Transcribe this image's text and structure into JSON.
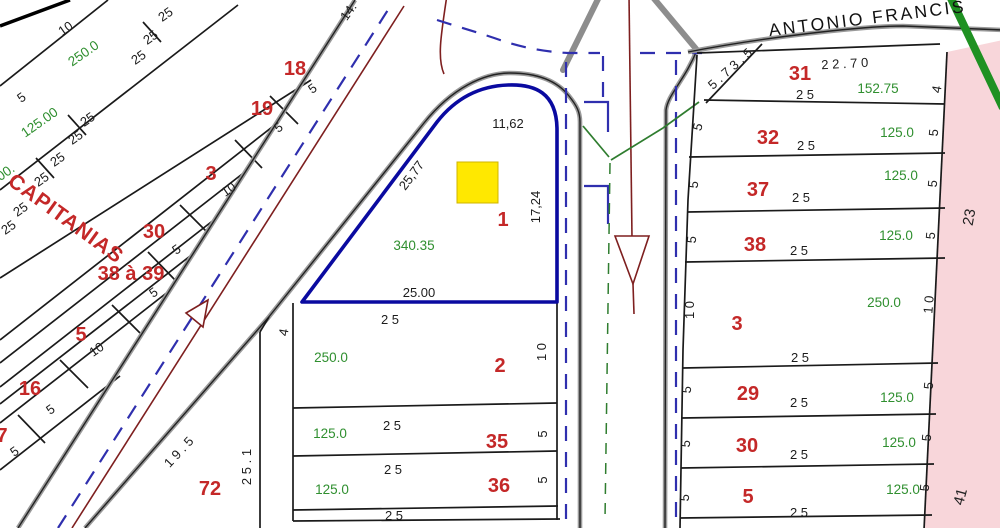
{
  "map": {
    "streets": {
      "diagonal_street": "CAPITANIAS",
      "top_street": "ANTONIO FRANCIS"
    },
    "highlight_lot": {
      "number": "1",
      "area": "340.35",
      "dim_top": "11,62",
      "dim_left": "25,77",
      "dim_right": "17,24",
      "dim_bottom": "25.00",
      "marker_color": "#ffe800",
      "outline_color": "#0a0aa0"
    },
    "colors": {
      "lot_number": "#c42828",
      "dimension": "#1c1c1c",
      "area": "#2f8f2f",
      "road_center_dash": "#2f2fae",
      "flow_line": "#7e1f1f",
      "utility_line": "#2f7d2f",
      "boundary_green": "#1f9122",
      "adjacent_fill": "#f8d6da"
    },
    "adjacent_plan_labels": [
      "23",
      "41"
    ],
    "labels": [
      {
        "t": "10",
        "x": 68,
        "y": 32,
        "r": -35,
        "k": "dim"
      },
      {
        "t": "250.0",
        "x": 86,
        "y": 57,
        "r": -35,
        "k": "area"
      },
      {
        "t": "25",
        "x": 168,
        "y": 18,
        "r": -35,
        "k": "dim"
      },
      {
        "t": "25",
        "x": 153,
        "y": 41,
        "r": -35,
        "k": "dim"
      },
      {
        "t": "25",
        "x": 141,
        "y": 61,
        "r": -35,
        "k": "dim"
      },
      {
        "t": "18",
        "x": 295,
        "y": 75,
        "r": 0,
        "k": "num"
      },
      {
        "t": "5",
        "x": 315,
        "y": 92,
        "r": -35,
        "k": "dim"
      },
      {
        "t": "19",
        "x": 262,
        "y": 115,
        "r": 0,
        "k": "num"
      },
      {
        "t": "5",
        "x": 281,
        "y": 131,
        "r": -35,
        "k": "dim"
      },
      {
        "t": "5",
        "x": 24,
        "y": 101,
        "r": -35,
        "k": "dim"
      },
      {
        "t": "125.00",
        "x": 42,
        "y": 126,
        "r": -35,
        "k": "area"
      },
      {
        "t": "25",
        "x": 90,
        "y": 123,
        "r": -35,
        "k": "dim"
      },
      {
        "t": "25",
        "x": 78,
        "y": 141,
        "r": -35,
        "k": "dim"
      },
      {
        "t": "3",
        "x": 211,
        "y": 180,
        "r": 0,
        "k": "num"
      },
      {
        "t": "10",
        "x": 231,
        "y": 193,
        "r": -35,
        "k": "dim"
      },
      {
        "t": "25",
        "x": 60,
        "y": 163,
        "r": -35,
        "k": "dim"
      },
      {
        "t": "25",
        "x": 44,
        "y": 183,
        "r": -35,
        "k": "dim"
      },
      {
        "t": "00.",
        "x": 8,
        "y": 176,
        "r": -35,
        "k": "area"
      },
      {
        "t": "30",
        "x": 154,
        "y": 238,
        "r": 0,
        "k": "num"
      },
      {
        "t": "5",
        "x": 179,
        "y": 253,
        "r": -35,
        "k": "dim"
      },
      {
        "t": "25",
        "x": 23,
        "y": 213,
        "r": -35,
        "k": "dim"
      },
      {
        "t": "25",
        "x": 11,
        "y": 231,
        "r": -35,
        "k": "dim"
      },
      {
        "t": "38 à 39",
        "x": 131,
        "y": 280,
        "r": 0,
        "k": "num"
      },
      {
        "t": "5",
        "x": 156,
        "y": 296,
        "r": -35,
        "k": "dim"
      },
      {
        "t": "5",
        "x": 81,
        "y": 341,
        "r": 0,
        "k": "num"
      },
      {
        "t": "10",
        "x": 99,
        "y": 353,
        "r": -35,
        "k": "dim"
      },
      {
        "t": "16",
        "x": 30,
        "y": 395,
        "r": 0,
        "k": "num"
      },
      {
        "t": "5",
        "x": 53,
        "y": 413,
        "r": -35,
        "k": "dim"
      },
      {
        "t": "7",
        "x": 2,
        "y": 442,
        "r": 0,
        "k": "num"
      },
      {
        "t": "5",
        "x": 17,
        "y": 455,
        "r": -35,
        "k": "dim"
      },
      {
        "t": "14.",
        "x": 352,
        "y": 14,
        "r": -55,
        "k": "dim"
      },
      {
        "t": "72",
        "x": 210,
        "y": 495,
        "r": 0,
        "k": "num"
      },
      {
        "t": "1 9 . 5",
        "x": 182,
        "y": 455,
        "r": -47,
        "k": "dim"
      },
      {
        "t": "2 5 . 1",
        "x": 251,
        "y": 467,
        "r": -90,
        "k": "dim"
      },
      {
        "t": "4",
        "x": 288,
        "y": 333,
        "r": -80,
        "k": "dim"
      },
      {
        "t": "2 5",
        "x": 390,
        "y": 324,
        "r": 0,
        "k": "dim"
      },
      {
        "t": "250.0",
        "x": 331,
        "y": 362,
        "r": 0,
        "k": "area"
      },
      {
        "t": "2",
        "x": 500,
        "y": 372,
        "r": 0,
        "k": "num"
      },
      {
        "t": "1 0",
        "x": 546,
        "y": 352,
        "r": -90,
        "k": "dim"
      },
      {
        "t": "2 5",
        "x": 392,
        "y": 430,
        "r": 0,
        "k": "dim"
      },
      {
        "t": "125.0",
        "x": 330,
        "y": 438,
        "r": 0,
        "k": "area"
      },
      {
        "t": "35",
        "x": 497,
        "y": 448,
        "r": 0,
        "k": "num"
      },
      {
        "t": "5",
        "x": 547,
        "y": 434,
        "r": -90,
        "k": "dim"
      },
      {
        "t": "2 5",
        "x": 393,
        "y": 474,
        "r": 0,
        "k": "dim"
      },
      {
        "t": "125.0",
        "x": 332,
        "y": 494,
        "r": 0,
        "k": "area"
      },
      {
        "t": "36",
        "x": 499,
        "y": 492,
        "r": 0,
        "k": "num"
      },
      {
        "t": "5",
        "x": 547,
        "y": 480,
        "r": -90,
        "k": "dim"
      },
      {
        "t": "2 5",
        "x": 394,
        "y": 520,
        "r": 0,
        "k": "dim"
      },
      {
        "t": "31",
        "x": 800,
        "y": 80,
        "r": 0,
        "k": "num"
      },
      {
        "t": "5 . 7 3 . 5",
        "x": 733,
        "y": 72,
        "r": -42,
        "k": "dim"
      },
      {
        "t": "2 2 . 7 0",
        "x": 845,
        "y": 68,
        "r": -3,
        "k": "dim"
      },
      {
        "t": "2 5",
        "x": 805,
        "y": 99,
        "r": 0,
        "k": "dim"
      },
      {
        "t": "152.75",
        "x": 878,
        "y": 93,
        "r": 0,
        "k": "area"
      },
      {
        "t": "4",
        "x": 941,
        "y": 90,
        "r": -80,
        "k": "dim"
      },
      {
        "t": "5",
        "x": 702,
        "y": 128,
        "r": -75,
        "k": "dim"
      },
      {
        "t": "32",
        "x": 768,
        "y": 144,
        "r": 0,
        "k": "num"
      },
      {
        "t": "2 5",
        "x": 806,
        "y": 150,
        "r": 0,
        "k": "dim"
      },
      {
        "t": "125.0",
        "x": 897,
        "y": 137,
        "r": 0,
        "k": "area"
      },
      {
        "t": "5",
        "x": 938,
        "y": 133,
        "r": -85,
        "k": "dim"
      },
      {
        "t": "5",
        "x": 698,
        "y": 185,
        "r": -85,
        "k": "dim"
      },
      {
        "t": "37",
        "x": 758,
        "y": 196,
        "r": 0,
        "k": "num"
      },
      {
        "t": "2 5",
        "x": 801,
        "y": 202,
        "r": 0,
        "k": "dim"
      },
      {
        "t": "125.0",
        "x": 901,
        "y": 180,
        "r": 0,
        "k": "area"
      },
      {
        "t": "5",
        "x": 937,
        "y": 184,
        "r": -85,
        "k": "dim"
      },
      {
        "t": "5",
        "x": 696,
        "y": 240,
        "r": -85,
        "k": "dim"
      },
      {
        "t": "38",
        "x": 755,
        "y": 251,
        "r": 0,
        "k": "num"
      },
      {
        "t": "2 5",
        "x": 799,
        "y": 255,
        "r": 0,
        "k": "dim"
      },
      {
        "t": "125.0",
        "x": 896,
        "y": 240,
        "r": 0,
        "k": "area"
      },
      {
        "t": "5",
        "x": 935,
        "y": 236,
        "r": -85,
        "k": "dim"
      },
      {
        "t": "1 0",
        "x": 694,
        "y": 310,
        "r": -90,
        "k": "dim"
      },
      {
        "t": "3",
        "x": 737,
        "y": 330,
        "r": 0,
        "k": "num"
      },
      {
        "t": "250.0",
        "x": 884,
        "y": 307,
        "r": 0,
        "k": "area"
      },
      {
        "t": "2 5",
        "x": 800,
        "y": 362,
        "r": 0,
        "k": "dim"
      },
      {
        "t": "1 0",
        "x": 933,
        "y": 305,
        "r": -85,
        "k": "dim"
      },
      {
        "t": "5",
        "x": 691,
        "y": 390,
        "r": -85,
        "k": "dim"
      },
      {
        "t": "29",
        "x": 748,
        "y": 400,
        "r": 0,
        "k": "num"
      },
      {
        "t": "2 5",
        "x": 799,
        "y": 407,
        "r": 0,
        "k": "dim"
      },
      {
        "t": "125.0",
        "x": 897,
        "y": 402,
        "r": 0,
        "k": "area"
      },
      {
        "t": "5",
        "x": 933,
        "y": 386,
        "r": -85,
        "k": "dim"
      },
      {
        "t": "5",
        "x": 690,
        "y": 444,
        "r": -85,
        "k": "dim"
      },
      {
        "t": "30",
        "x": 747,
        "y": 452,
        "r": 0,
        "k": "num"
      },
      {
        "t": "2 5",
        "x": 799,
        "y": 459,
        "r": 0,
        "k": "dim"
      },
      {
        "t": "125.0",
        "x": 899,
        "y": 447,
        "r": 0,
        "k": "area"
      },
      {
        "t": "5",
        "x": 931,
        "y": 438,
        "r": -85,
        "k": "dim"
      },
      {
        "t": "5",
        "x": 689,
        "y": 498,
        "r": -85,
        "k": "dim"
      },
      {
        "t": "5",
        "x": 748,
        "y": 503,
        "r": 0,
        "k": "num"
      },
      {
        "t": "2 5",
        "x": 799,
        "y": 517,
        "r": 0,
        "k": "dim"
      },
      {
        "t": "125.0",
        "x": 903,
        "y": 494,
        "r": 0,
        "k": "area"
      },
      {
        "t": "5",
        "x": 929,
        "y": 488,
        "r": -85,
        "k": "dim"
      },
      {
        "t": "23",
        "x": 974,
        "y": 218,
        "r": -80,
        "k": "dim-lg"
      },
      {
        "t": "41",
        "x": 965,
        "y": 498,
        "r": -75,
        "k": "dim-lg"
      }
    ]
  }
}
